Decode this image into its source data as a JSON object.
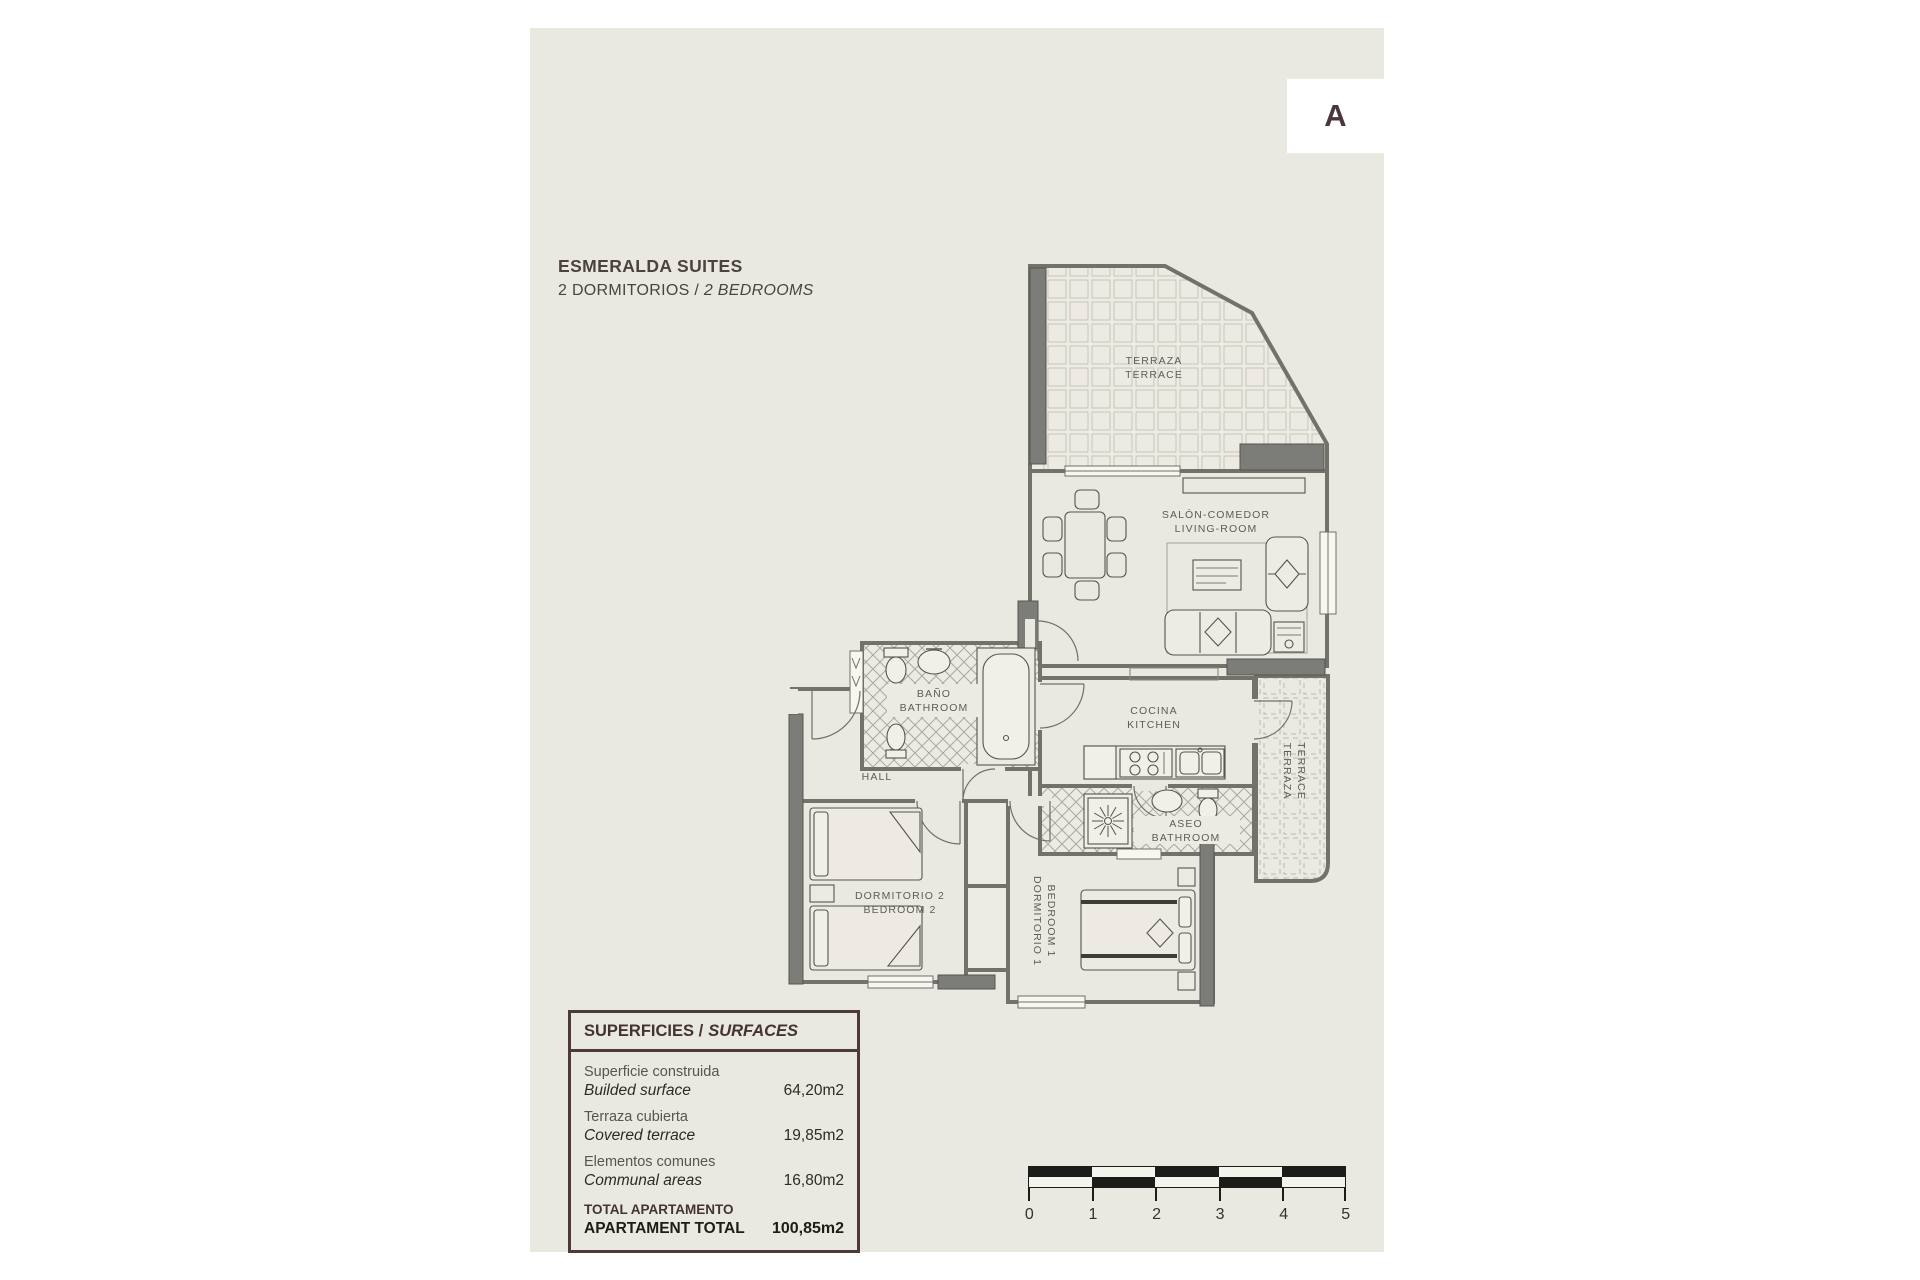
{
  "page": {
    "unit_label": "A"
  },
  "header": {
    "title": "ESMERALDA SUITES",
    "subtitle_es": "2 DORMITORIOS /",
    "subtitle_en": "2 BEDROOMS"
  },
  "rooms": {
    "terrace_top": {
      "line1": "TERRAZA",
      "line2": "TERRACE"
    },
    "living": {
      "line1": "SALÓN-COMEDOR",
      "line2": "LIVING-ROOM"
    },
    "bathroom_main": {
      "line1": "BAÑO",
      "line2": "BATHROOM"
    },
    "hall": {
      "label": "HALL"
    },
    "kitchen": {
      "line1": "COCINA",
      "line2": "KITCHEN"
    },
    "bathroom_small": {
      "line1": "ASEO",
      "line2": "BATHROOM"
    },
    "terrace_side": {
      "line1": "TERRAZA",
      "line2": "TERRACE"
    },
    "bedroom2": {
      "line1": "DORMITORIO 2",
      "line2": "BEDROOM 2"
    },
    "bedroom1": {
      "line1": "DORMITORIO 1",
      "line2": "BEDROOM 1"
    }
  },
  "surfaces": {
    "title_es": "SUPERFICIES /",
    "title_en": "SURFACES",
    "rows": [
      {
        "es": "Superficie construida",
        "en": "Builded surface",
        "value": "64,20m2"
      },
      {
        "es": "Terraza cubierta",
        "en": "Covered terrace",
        "value": "19,85m2"
      },
      {
        "es": "Elementos comunes",
        "en": "Communal areas",
        "value": "16,80m2"
      }
    ],
    "total": {
      "es": "TOTAL APARTAMENTO",
      "en": "APARTAMENT TOTAL",
      "value": "100,85m2"
    }
  },
  "scale_bar": {
    "ticks": [
      "0",
      "1",
      "2",
      "3",
      "4",
      "5"
    ]
  },
  "colors": {
    "page_background": "#e9e8e1",
    "accent_brown": "#4e3a3a",
    "wall_dark": "#7c7c78"
  }
}
